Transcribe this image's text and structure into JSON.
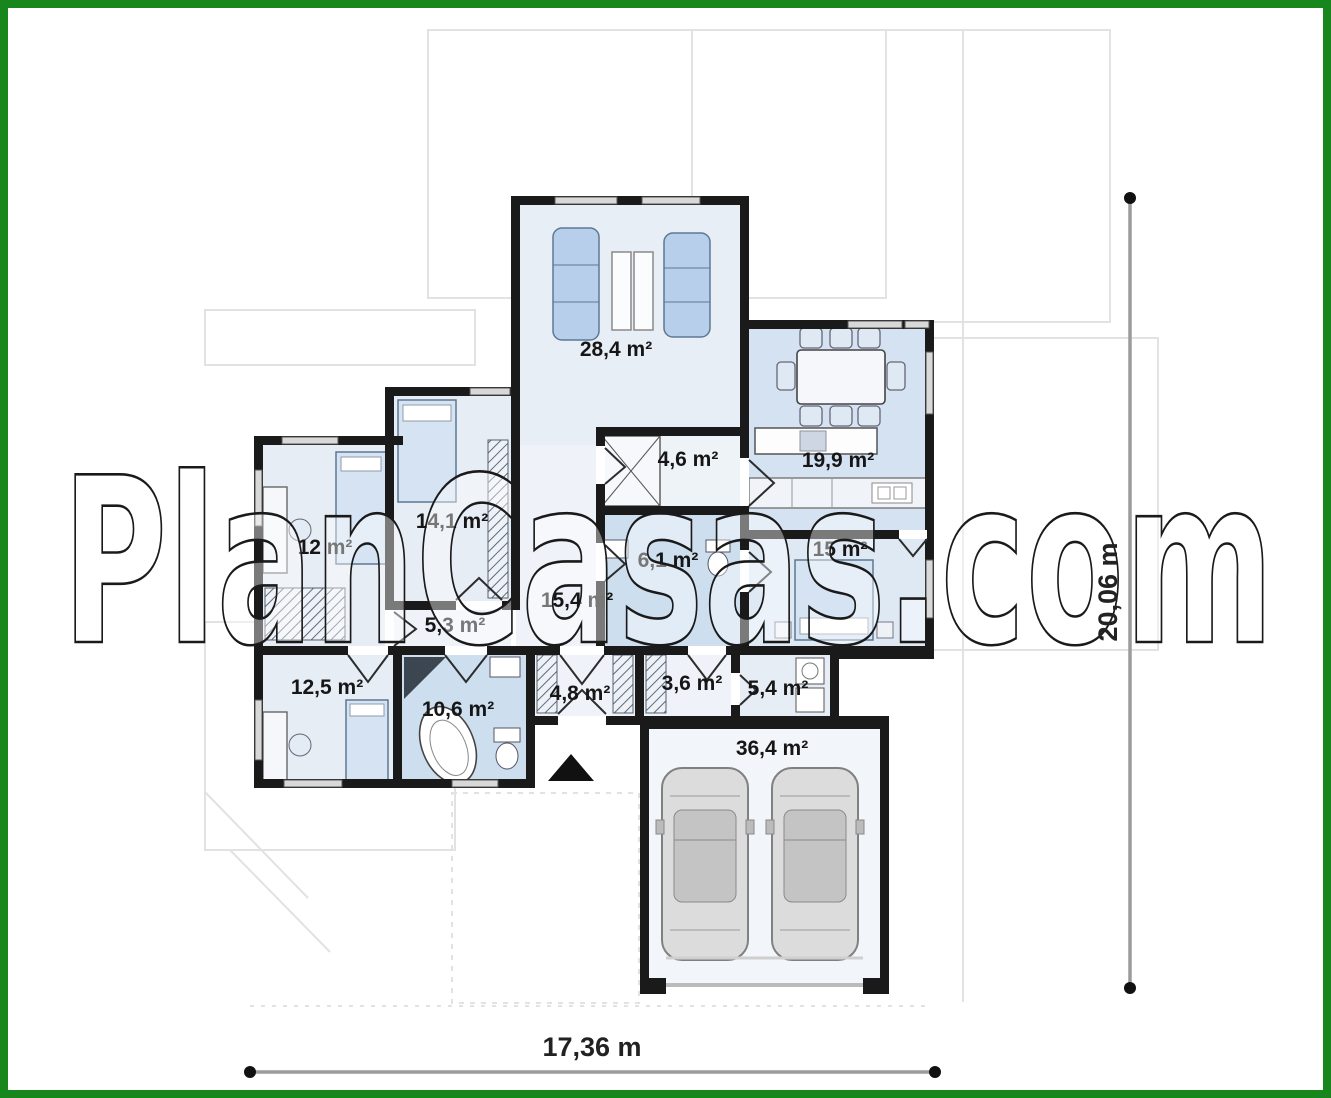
{
  "watermark": {
    "text": "PlanCasas.com"
  },
  "dimensions": {
    "width": "17,36 m",
    "height": "20,06 m"
  },
  "rooms": {
    "living": {
      "area": "28,4 m²"
    },
    "dining": {
      "area": "19,9 m²"
    },
    "pantry": {
      "area": "4,6 m²"
    },
    "bathroom_small": {
      "area": "6,1 m²"
    },
    "bedroom_right": {
      "area": "15 m²"
    },
    "bedroom_left_upper": {
      "area": "14,1 m²"
    },
    "bedroom_left": {
      "area": "12 m²"
    },
    "hall_small": {
      "area": "5,3 m²"
    },
    "corridor": {
      "area": "15,4 m²"
    },
    "bedroom_bottom": {
      "area": "12,5 m²"
    },
    "bathroom_main": {
      "area": "10,6 m²"
    },
    "wardrobe_hall": {
      "area": "4,8 m²"
    },
    "entry_hall": {
      "area": "3,6 m²"
    },
    "utility": {
      "area": "5,4 m²"
    },
    "garage": {
      "area": "36,4 m²"
    }
  },
  "colors": {
    "frame_green": "#17861d",
    "wall_black": "#1a1a1a",
    "room_light": "#e7eef6",
    "room_blue": "#cddeef",
    "furniture_blue": "#b7cfeb",
    "roof_gray": "#e2e2e2",
    "dimension_gray": "#9b9b9b"
  }
}
